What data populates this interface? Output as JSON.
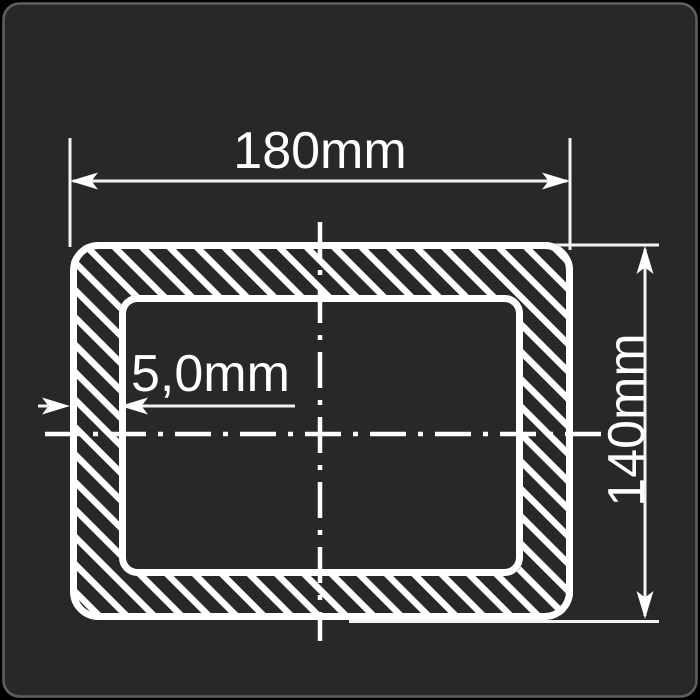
{
  "drawing": {
    "type": "rectangular-hollow-section-cross-section",
    "dimensions": {
      "width_label": "180mm",
      "height_label": "140mm",
      "wall_thickness_label": "5,0mm"
    },
    "colors": {
      "background": "#282828",
      "outside_corners": "#000000",
      "frame_border": "#606060",
      "line": "#ffffff"
    },
    "style": {
      "hatch_direction": "diagonal-top-left-to-bottom-right",
      "centerline_pattern": "dash-dot"
    }
  }
}
